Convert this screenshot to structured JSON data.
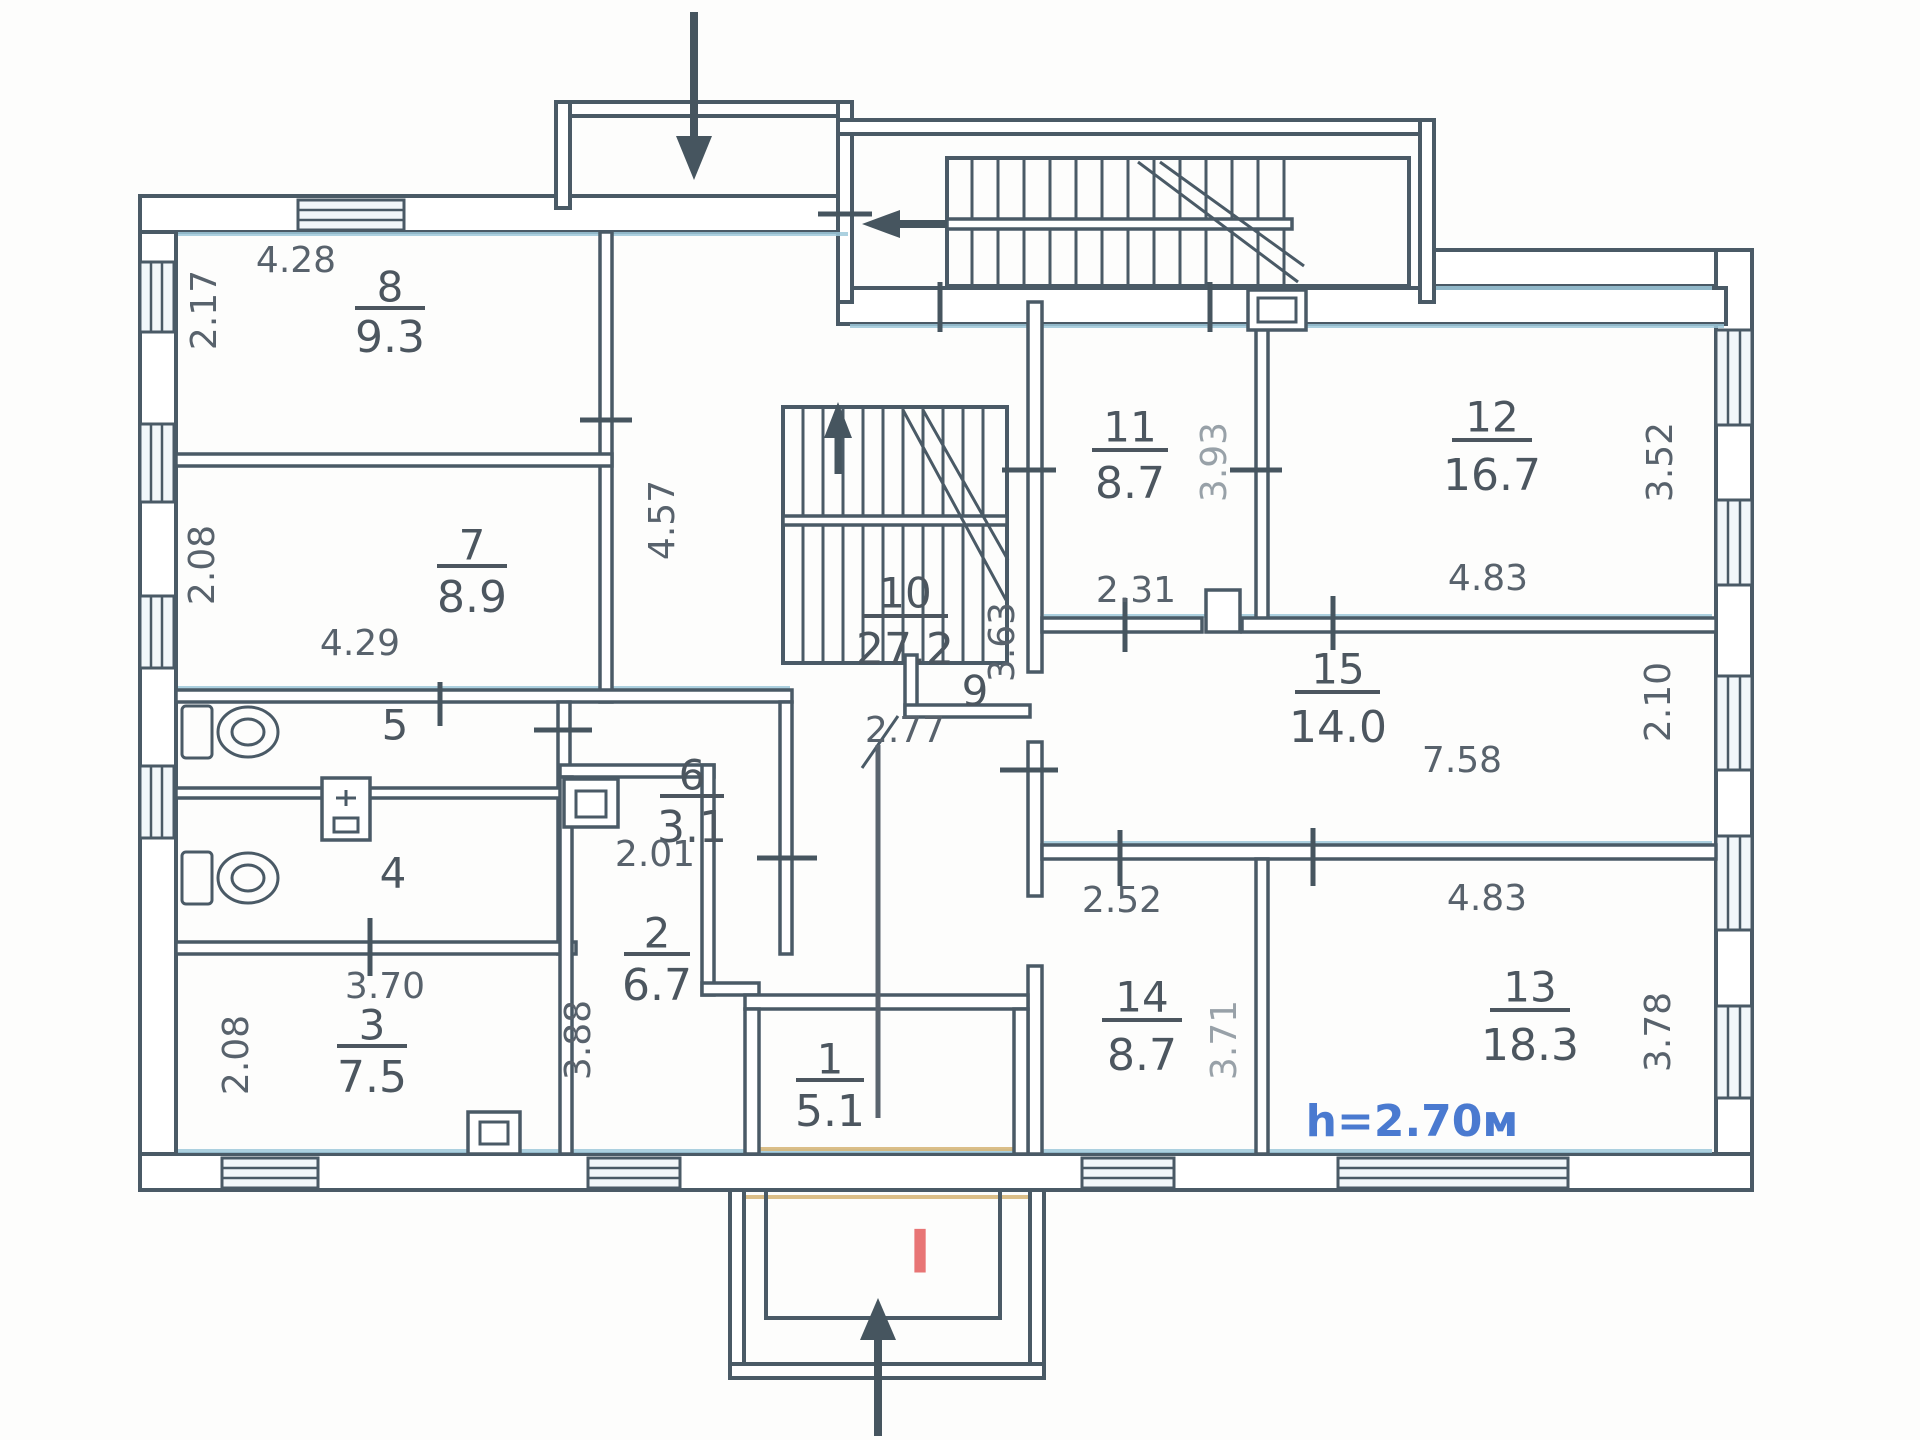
{
  "colors": {
    "wall_line": "#4a5a66",
    "accent_blue": "#9ec9db",
    "accent_tan": "#d8b87c",
    "height_note_color": "#4a7ad0",
    "entrance_mark_color": "#e87575"
  },
  "rooms": {
    "r1": {
      "number": "1",
      "area": "5.1"
    },
    "r2": {
      "number": "2",
      "area": "6.7",
      "dim_w": "2.01",
      "dim_h": "3.88"
    },
    "r3": {
      "number": "3",
      "area": "7.5",
      "dim_w": "3.70",
      "dim_h": "2.08"
    },
    "r4": {
      "number": "4"
    },
    "r5": {
      "number": "5"
    },
    "r6": {
      "number": "6",
      "area": "3.1"
    },
    "r7": {
      "number": "7",
      "area": "8.9",
      "dim_w": "4.29",
      "dim_h": "2.08"
    },
    "r8": {
      "number": "8",
      "area": "9.3",
      "dim_w": "4.28",
      "dim_h": "2.17"
    },
    "r9": {
      "number": "9"
    },
    "r10": {
      "number": "10",
      "area": "27.2",
      "dim_w": "2.77",
      "dim_h": "3.63",
      "dim_left": "4.57"
    },
    "r11": {
      "number": "11",
      "area": "8.7",
      "dim_w": "2.31",
      "dim_h": "3.93"
    },
    "r12": {
      "number": "12",
      "area": "16.7",
      "dim_w": "4.83",
      "dim_h": "3.52"
    },
    "r13": {
      "number": "13",
      "area": "18.3",
      "dim_w": "4.83",
      "dim_h": "3.78",
      "height_note": "h=2.70м"
    },
    "r14": {
      "number": "14",
      "area": "8.7",
      "dim_w": "2.52",
      "dim_h": "3.71"
    },
    "r15": {
      "number": "15",
      "area": "14.0",
      "dim_w": "7.58",
      "dim_h": "2.10"
    }
  },
  "entrance": {
    "mark": "I"
  }
}
